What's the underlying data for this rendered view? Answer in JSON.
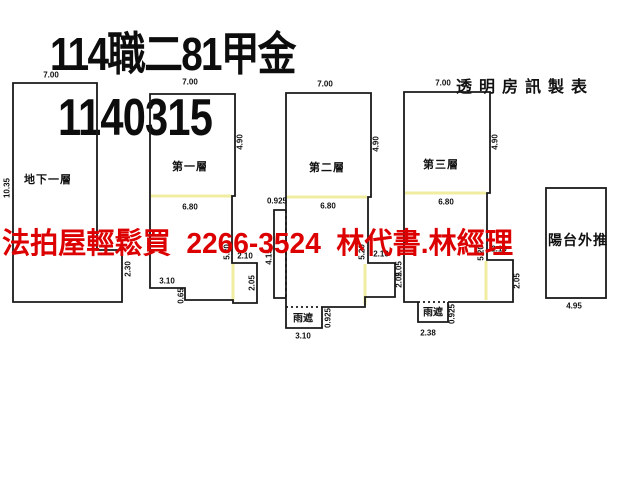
{
  "title": {
    "line1": "114職二81甲金",
    "line2": "1140315"
  },
  "maker": {
    "label": "透明房訊製表"
  },
  "ad": {
    "left": "法拍屋輕鬆買",
    "phone": "2266-3524",
    "right": "林代書.林經理"
  },
  "colors": {
    "accent_red": "#dd0000",
    "highlight_yellow": "#f0eda0",
    "line_black": "#1a1a1a"
  },
  "plans": {
    "basement": {
      "name": "地下一層",
      "top": "7.00",
      "left": "10.35",
      "right": "2.30"
    },
    "f1": {
      "name": "第一層",
      "top": "7.00",
      "right": "4.90",
      "inner": "6.80",
      "bottom_w": "3.10",
      "step_h": "0.65",
      "inner_h": "5.20",
      "ext_w": "2.10",
      "ext_h": "2.05"
    },
    "f2": {
      "name": "第二層",
      "top": "7.00",
      "right": "4.90",
      "inner": "6.80",
      "strip_w": "0.925",
      "strip_h": "4.15",
      "inner_h": "5.20",
      "ext_w": "2.10",
      "ext_h": "2.05",
      "canopy_label": "雨遮",
      "canopy_w": "3.10",
      "canopy_h": "0.925"
    },
    "f3": {
      "name": "第三層",
      "top": "7.00",
      "right": "4.90",
      "inner": "6.80",
      "left_h": "2.05",
      "inner_h": "5.20",
      "ext_w": "2.10",
      "ext_h": "2.05",
      "canopy_label": "雨遮",
      "canopy_w": "2.38",
      "canopy_h": "0.925"
    },
    "balcony": {
      "name": "陽台外推",
      "bottom": "4.95"
    }
  }
}
